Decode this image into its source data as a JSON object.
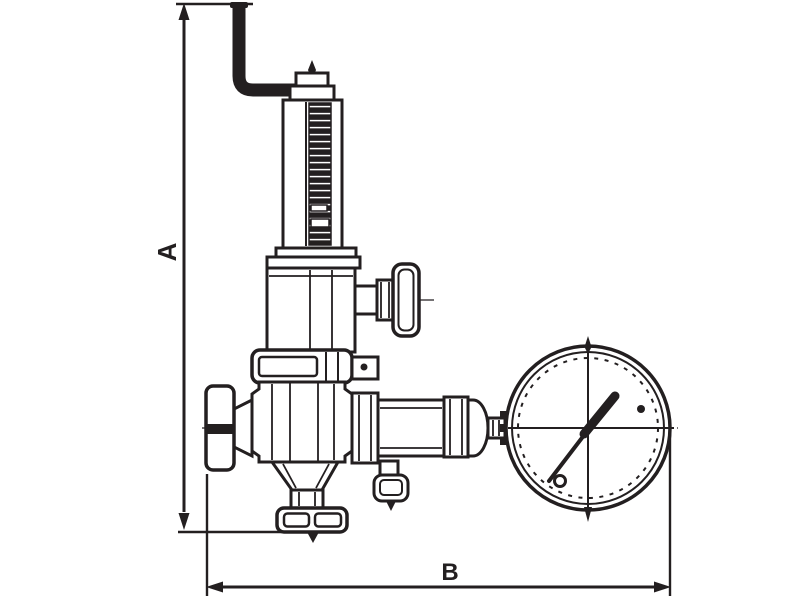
{
  "drawing": {
    "type": "technical-dimension-drawing",
    "line_color": "#231f20",
    "background_color": "#ffffff",
    "dimensions": {
      "vertical_label": "A",
      "horizontal_label": "B"
    },
    "parts": [
      "relief-discharge-pipe",
      "spring-housing",
      "adjusting-handle",
      "valve-bonnet",
      "valve-body",
      "inlet-cap",
      "outlet-coupling",
      "drain-fitting",
      "bottom-connection",
      "pressure-gauge"
    ]
  }
}
